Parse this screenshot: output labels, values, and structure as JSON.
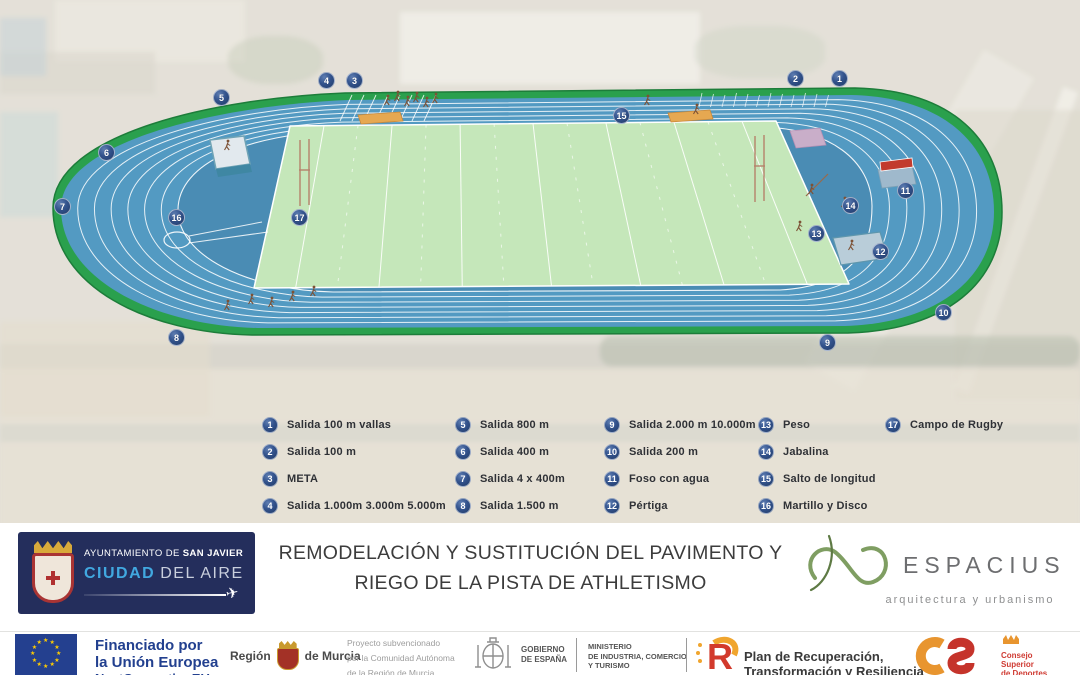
{
  "title": {
    "line1": "REMODELACIÓN Y SUSTITUCIÓN DEL PAVIMENTO Y",
    "line2": "RIEGO DE LA PISTA DE ATHLETISMO"
  },
  "legend": {
    "columns": [
      {
        "x": 262,
        "items": [
          {
            "n": "1",
            "label": "Salida 100 m vallas"
          },
          {
            "n": "2",
            "label": "Salida 100 m"
          },
          {
            "n": "3",
            "label": "META"
          },
          {
            "n": "4",
            "label": "Salida 1.000m 3.000m 5.000m"
          }
        ]
      },
      {
        "x": 455,
        "items": [
          {
            "n": "5",
            "label": "Salida 800 m"
          },
          {
            "n": "6",
            "label": "Salida 400 m"
          },
          {
            "n": "7",
            "label": "Salida 4 x 400m"
          },
          {
            "n": "8",
            "label": "Salida 1.500 m"
          }
        ]
      },
      {
        "x": 604,
        "items": [
          {
            "n": "9",
            "label": "Salida 2.000 m 10.000m"
          },
          {
            "n": "10",
            "label": "Salida 200 m"
          },
          {
            "n": "11",
            "label": "Foso con agua"
          },
          {
            "n": "12",
            "label": "Pértiga"
          }
        ]
      },
      {
        "x": 758,
        "items": [
          {
            "n": "13",
            "label": "Peso"
          },
          {
            "n": "14",
            "label": "Jabalina"
          },
          {
            "n": "15",
            "label": "Salto de longitud"
          },
          {
            "n": "16",
            "label": "Martillo y Disco"
          }
        ]
      },
      {
        "x": 885,
        "items": [
          {
            "n": "17",
            "label": "Campo de Rugby"
          }
        ]
      }
    ],
    "top": 416,
    "row_height": 27
  },
  "markers": [
    {
      "n": "1",
      "x": 840,
      "y": 79
    },
    {
      "n": "2",
      "x": 796,
      "y": 79
    },
    {
      "n": "3",
      "x": 355,
      "y": 81
    },
    {
      "n": "4",
      "x": 327,
      "y": 81
    },
    {
      "n": "5",
      "x": 222,
      "y": 98
    },
    {
      "n": "6",
      "x": 107,
      "y": 153
    },
    {
      "n": "7",
      "x": 63,
      "y": 207
    },
    {
      "n": "8",
      "x": 177,
      "y": 338
    },
    {
      "n": "9",
      "x": 828,
      "y": 343
    },
    {
      "n": "10",
      "x": 944,
      "y": 313
    },
    {
      "n": "11",
      "x": 906,
      "y": 191
    },
    {
      "n": "12",
      "x": 881,
      "y": 252
    },
    {
      "n": "13",
      "x": 817,
      "y": 234
    },
    {
      "n": "14",
      "x": 851,
      "y": 206
    },
    {
      "n": "15",
      "x": 622,
      "y": 116
    },
    {
      "n": "16",
      "x": 177,
      "y": 218
    },
    {
      "n": "17",
      "x": 300,
      "y": 218
    }
  ],
  "san_javier": {
    "line1_prefix": "AYUNTAMIENTO DE ",
    "line1_bold": "SAN JAVIER",
    "line2_blue": "CIUDAD",
    "line2_rest": "DEL AIRE"
  },
  "espacius": {
    "name": "ESPACIUS",
    "tagline": "arquitectura y urbanismo"
  },
  "funding": {
    "eu": {
      "line1": "Financiado por",
      "line2": "la Unión Europea",
      "line3": "NextGenerationEU"
    },
    "murcia": {
      "pre": "Región",
      "post": "de Murcia"
    },
    "grant": {
      "line1": "Proyecto subvencionado",
      "line2": "por la Comunidad Autónoma",
      "line3": "de la Región de Murcia"
    },
    "gobierno": {
      "line1": "GOBIERNO",
      "line2": "DE ESPAÑA"
    },
    "ministerio": {
      "line1": "MINISTERIO",
      "line2": "DE INDUSTRIA, COMERCIO",
      "line3": "Y TURISMO"
    },
    "plan": {
      "line1": "Plan de Recuperación,",
      "line2": "Transformación y Resiliencia"
    },
    "csd": {
      "line1": "Consejo",
      "line2": "Superior",
      "line3": "de Deportes"
    }
  },
  "icons": {
    "eu_star": "★",
    "plane": "✈",
    "plan_r": "R"
  },
  "colors": {
    "track_blue": "#539ac2",
    "dzone_blue": "#4a8cb4",
    "border_green": "#2aa04d",
    "infield_green": "#c5e7ba",
    "marker_navy": "#2c4576",
    "eu_blue": "#22408f",
    "espacius_green": "#7f9e62",
    "csd_orange": "#e8952f",
    "csd_red": "#c5342b"
  }
}
